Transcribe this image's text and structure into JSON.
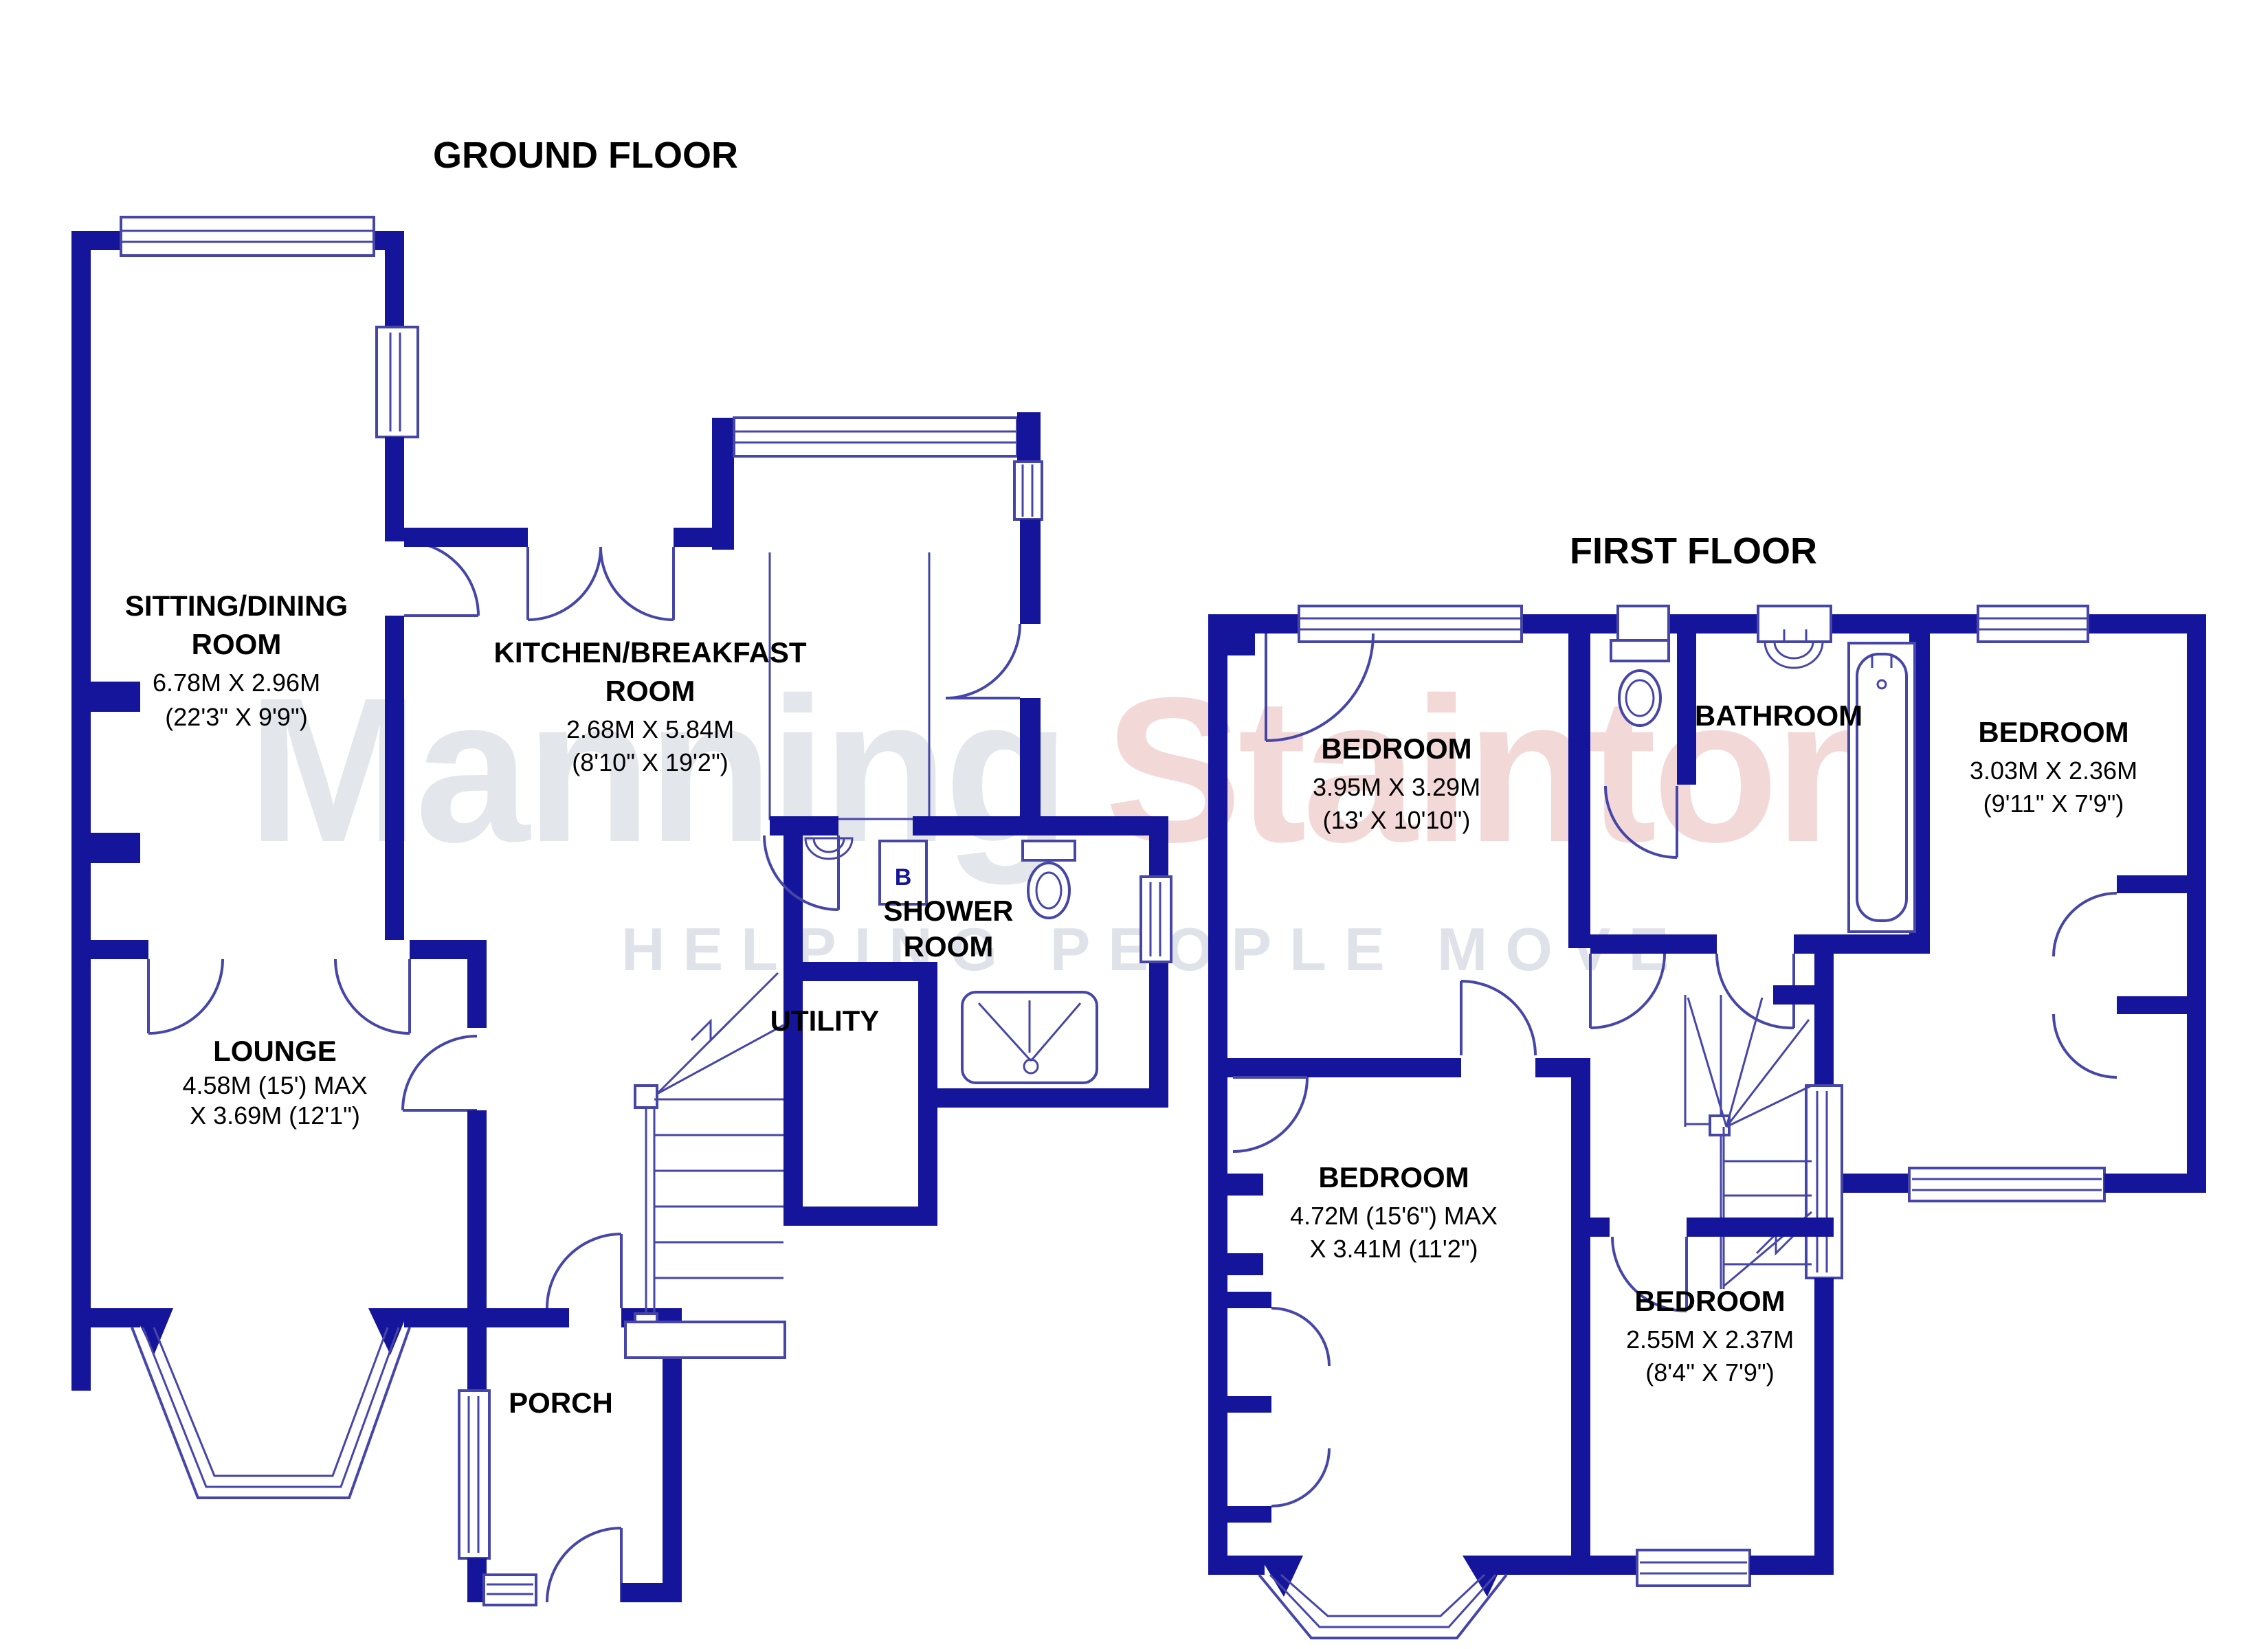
{
  "colors": {
    "wall": "#15159B",
    "line": "#4646A8",
    "text": "#000000",
    "wm_word1": "#e3e6eb",
    "wm_word2": "#f3d8d8",
    "wm_tagline": "#dfe3e9"
  },
  "watermark": {
    "word1": "Manning",
    "word2": "Stainton",
    "tagline": "HELPING PEOPLE MOVE"
  },
  "ground_floor": {
    "title": "GROUND FLOOR",
    "boiler_label": "B",
    "rooms": [
      {
        "id": "sitting-dining-room",
        "name": "SITTING/DINING",
        "name2": "ROOM",
        "dim1": "6.78M X 2.96M",
        "dim2": "(22'3\" X 9'9\")"
      },
      {
        "id": "kitchen-breakfast-room",
        "name": "KITCHEN/BREAKFAST",
        "name2": "ROOM",
        "dim1": "2.68M X 5.84M",
        "dim2": "(8'10\" X 19'2\")"
      },
      {
        "id": "shower-room",
        "name": "SHOWER",
        "name2": "ROOM"
      },
      {
        "id": "utility",
        "name": "UTILITY"
      },
      {
        "id": "lounge",
        "name": "LOUNGE",
        "dim1": "4.58M (15') MAX",
        "dim2": "X 3.69M (12'1\")"
      },
      {
        "id": "porch",
        "name": "PORCH"
      }
    ]
  },
  "first_floor": {
    "title": "FIRST FLOOR",
    "rooms": [
      {
        "id": "bedroom-front",
        "name": "BEDROOM",
        "dim1": "3.95M X 3.29M",
        "dim2": "(13' X 10'10\")"
      },
      {
        "id": "bathroom",
        "name": "BATHROOM"
      },
      {
        "id": "bedroom-rear-right",
        "name": "BEDROOM",
        "dim1": "3.03M X 2.36M",
        "dim2": "(9'11\" X 7'9\")"
      },
      {
        "id": "bedroom-rear",
        "name": "BEDROOM",
        "dim1": "4.72M (15'6\") MAX",
        "dim2": "X 3.41M (11'2\")"
      },
      {
        "id": "bedroom-small",
        "name": "BEDROOM",
        "dim1": "2.55M X 2.37M",
        "dim2": "(8'4\" X 7'9\")"
      }
    ]
  }
}
